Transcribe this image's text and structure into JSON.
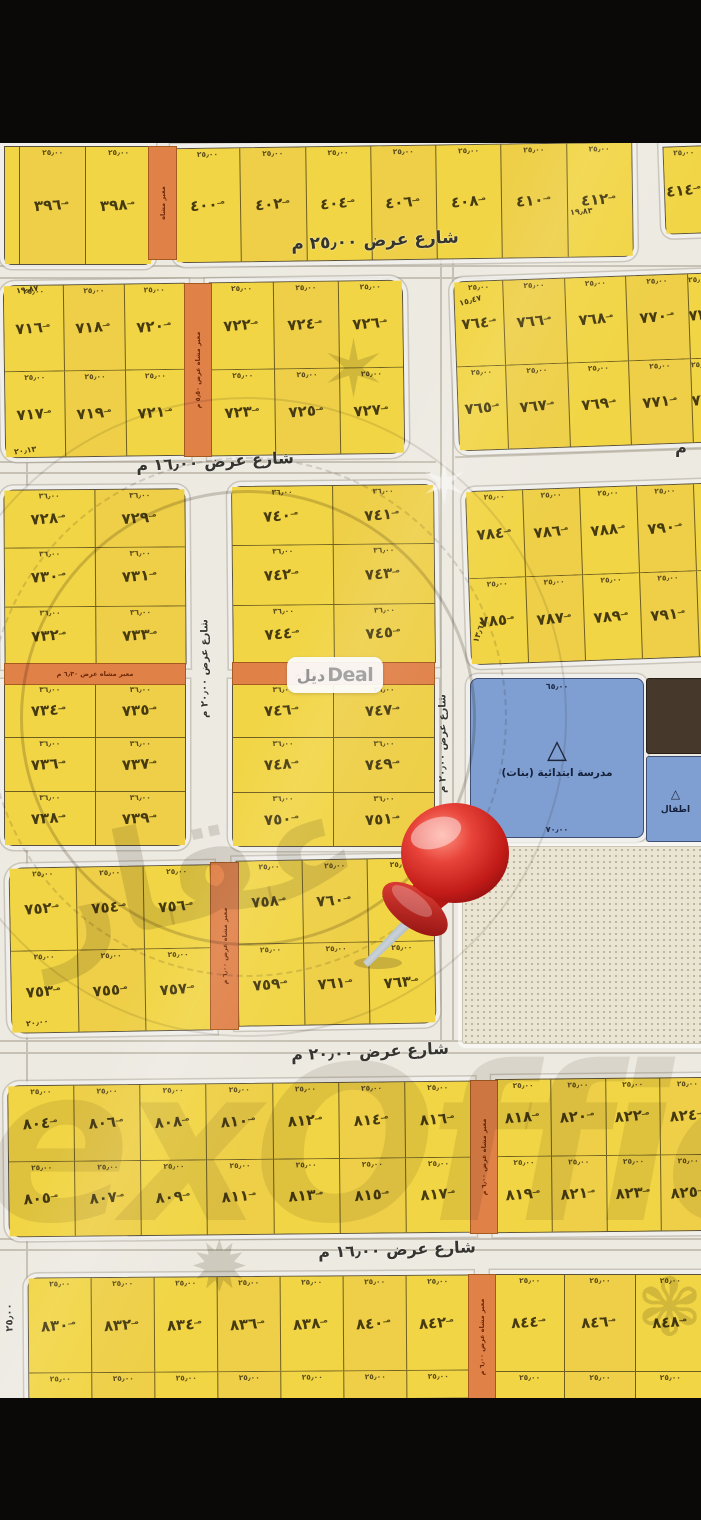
{
  "watermark": {
    "pill_ar": "ديل",
    "pill_en": "Deal",
    "big": "exOffice",
    "stamp": "عقار"
  },
  "school": {
    "name": "مدرسة ابتدائية (بنات)",
    "dim_top": "٦٥٫٠٠",
    "dim_bottom": "٧٠٫٠٠",
    "secondary": "اطفال"
  },
  "map": {
    "streets": [
      {
        "id": "s1",
        "label": "شارع عرض ٢٥٫٠٠ م"
      },
      {
        "id": "s2",
        "label": "شارع عرض ١٦٫٠٠ م"
      },
      {
        "id": "s2r",
        "label": "م"
      },
      {
        "id": "sv1",
        "label": "شارع عرض ٢٠٫٠٠ م"
      },
      {
        "id": "sv2",
        "label": "شارع عرض ٢٠٫٠٠ م"
      },
      {
        "id": "s3",
        "label": "شارع عرض ٢٠٫٠٠ م"
      },
      {
        "id": "s4",
        "label": "شارع عرض ١٦٫٠٠ م"
      },
      {
        "id": "sleft",
        "label": "٢٥٫٠٠"
      }
    ],
    "passages": [
      {
        "id": "pt",
        "label": "معبر مشاه"
      },
      {
        "id": "pb",
        "label": "معبر مشاه عرض ٥٫٥٠ م"
      },
      {
        "id": "pc1",
        "label": "معبر مشاه عرض ٦٫٣٠ م"
      },
      {
        "id": "pc2",
        "label": "معبر مشاه عرض ٦٫٢٥ م"
      },
      {
        "id": "pd",
        "label": "معبر مشاه عرض ٦٫٠٠ م"
      },
      {
        "id": "pe",
        "label": "معبر مشاه عرض ٦٫٠٠ م"
      },
      {
        "id": "pf",
        "label": "معبر مشاه عرض ٦٫٠٠ م"
      }
    ],
    "edge_dims": [
      {
        "id": "d1",
        "text": "١٩٫٨٣"
      },
      {
        "id": "d2",
        "text": "١٩٫٨٧"
      },
      {
        "id": "d3",
        "text": "٢٠٫١٣"
      },
      {
        "id": "d4",
        "text": "١٥٫٤٧"
      },
      {
        "id": "d5",
        "text": "١٣٫٦٨"
      },
      {
        "id": "d6",
        "text": "٢٠٫٠٠"
      }
    ],
    "blocks": [
      {
        "id": "T1",
        "dim": "٢٥٫٠٠",
        "rows": [
          [
            "",
            "٣٩٦",
            "٣٩٨"
          ]
        ]
      },
      {
        "id": "T2",
        "dim": "٢٥٫٠٠",
        "rows": [
          [
            "٤٠٠",
            "٤٠٢",
            "٤٠٤",
            "٤٠٦",
            "٤٠٨",
            "٤١٠",
            "٤١٢"
          ]
        ]
      },
      {
        "id": "T3",
        "dim": "٢٥٫٠٠",
        "rows": [
          [
            "٤١٤"
          ]
        ]
      },
      {
        "id": "B1",
        "dim": "٢٥٫٠٠",
        "rows": [
          [
            "٧١٦",
            "٧١٨",
            "٧٢٠"
          ],
          [
            "٧١٧",
            "٧١٩",
            "٧٢١"
          ]
        ]
      },
      {
        "id": "B1b",
        "dim": "٢٥٫٠٠",
        "rows": [
          [
            "٧٢٢",
            "٧٢٤",
            "٧٢٦"
          ],
          [
            "٧٢٣",
            "٧٢٥",
            "٧٢٧"
          ]
        ]
      },
      {
        "id": "B2",
        "dim": "٢٥٫٠٠",
        "rows": [
          [
            "٧٦٤",
            "٧٦٦",
            "٧٦٨",
            "٧٧٠",
            "٧٧٢"
          ],
          [
            "٧٦٥",
            "٧٦٧",
            "٧٦٩",
            "٧٧١",
            "٧٧٣"
          ]
        ]
      },
      {
        "id": "C1a",
        "dim": "٣٦٫٠٠",
        "rows": [
          [
            "٧٢٨",
            "٧٢٩"
          ],
          [
            "٧٣٠",
            "٧٣١"
          ],
          [
            "٧٣٢",
            "٧٣٣"
          ]
        ]
      },
      {
        "id": "C1b",
        "dim": "٣٦٫٠٠",
        "rows": [
          [
            "٧٣٤",
            "٧٣٥"
          ],
          [
            "٧٣٦",
            "٧٣٧"
          ],
          [
            "٧٣٨",
            "٧٣٩"
          ]
        ]
      },
      {
        "id": "C2a",
        "dim": "٣٦٫٠٠",
        "rows": [
          [
            "٧٤٠",
            "٧٤١"
          ],
          [
            "٧٤٢",
            "٧٤٣"
          ],
          [
            "٧٤٤",
            "٧٤٥"
          ]
        ]
      },
      {
        "id": "C2b",
        "dim": "٣٦٫٠٠",
        "rows": [
          [
            "٧٤٦",
            "٧٤٧"
          ],
          [
            "٧٤٨",
            "٧٤٩"
          ],
          [
            "٧٥٠",
            "٧٥١"
          ]
        ]
      },
      {
        "id": "C4",
        "dim": "٢٥٫٠٠",
        "rows": [
          [
            "٧٨٤",
            "٧٨٦",
            "٧٨٨",
            "٧٩٠",
            ""
          ],
          [
            "٧٨٥",
            "٧٨٧",
            "٧٨٩",
            "٧٩١",
            ""
          ]
        ]
      },
      {
        "id": "D1",
        "dim": "٢٥٫٠٠",
        "rows": [
          [
            "٧٥٢",
            "٧٥٤",
            "٧٥٦"
          ],
          [
            "٧٥٣",
            "٧٥٥",
            "٧٥٧"
          ]
        ]
      },
      {
        "id": "D2",
        "dim": "٢٥٫٠٠",
        "rows": [
          [
            "٧٥٨",
            "٧٦٠",
            "٧٦٢"
          ],
          [
            "٧٥٩",
            "٧٦١",
            "٧٦٣"
          ]
        ]
      },
      {
        "id": "EL",
        "dim": "٢٥٫٠٠",
        "rows": [
          [
            "٨٠٤",
            "٨٠٦",
            "٨٠٨",
            "٨١٠",
            "٨١٢",
            "٨١٤",
            "٨١٦"
          ],
          [
            "٨٠٥",
            "٨٠٧",
            "٨٠٩",
            "٨١١",
            "٨١٣",
            "٨١٥",
            "٨١٧"
          ]
        ]
      },
      {
        "id": "ER",
        "dim": "٢٥٫٠٠",
        "rows": [
          [
            "٨١٨",
            "٨٢٠",
            "٨٢٢",
            "٨٢٤"
          ],
          [
            "٨١٩",
            "٨٢١",
            "٨٢٣",
            "٨٢٥"
          ]
        ]
      },
      {
        "id": "FL",
        "dim": "٢٥٫٠٠",
        "dimEmpty": true,
        "rows": [
          [
            "٨٣٠",
            "٨٣٢",
            "٨٣٤",
            "٨٣٦",
            "٨٣٨",
            "٨٤٠",
            "٨٤٢"
          ],
          [
            "",
            "",
            "",
            "",
            "",
            "",
            ""
          ]
        ]
      },
      {
        "id": "FR",
        "dim": "٢٥٫٠٠",
        "dimEmpty": true,
        "rows": [
          [
            "٨٤٤",
            "٨٤٦",
            "٨٤٨"
          ],
          [
            "",
            "",
            ""
          ]
        ]
      }
    ]
  }
}
